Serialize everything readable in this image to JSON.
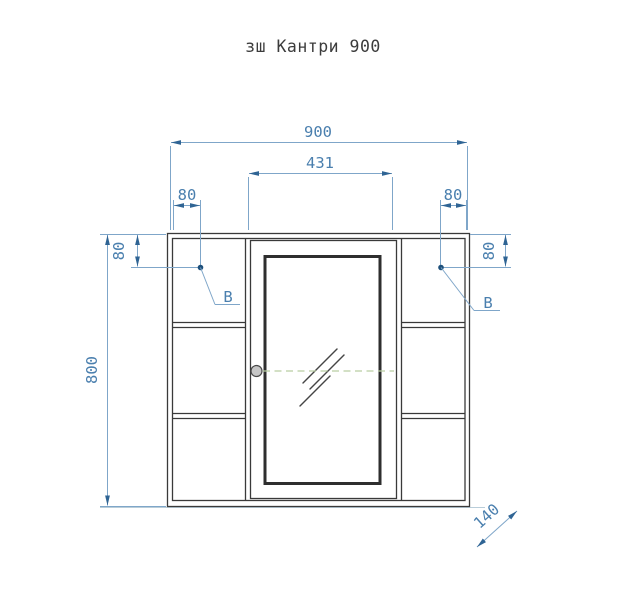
{
  "title": "зш Кантри 900",
  "dimensions": {
    "overall_width": "900",
    "door_width": "431",
    "left_top_offset": "80",
    "left_side_offset": "80",
    "right_top_offset": "80",
    "right_side_offset": "80",
    "overall_height": "800",
    "depth": "140"
  },
  "detail_labels": {
    "left": "B",
    "right": "B"
  },
  "colors": {
    "dim-line": "#7fa6c9",
    "dim-text": "#4a7fae",
    "dim-arrow": "#2f6494",
    "detail-dot": "#1d4f7a",
    "outline": "#3a3a3a",
    "mirror-frame": "#2e2e2e",
    "centerline": "#b9cda2",
    "handle-fill": "#c6c6c6",
    "handle-stroke": "#4a4a4a",
    "ground-line": "#b9cdd9",
    "title-text": "#3c3c3c",
    "background": "#ffffff"
  }
}
